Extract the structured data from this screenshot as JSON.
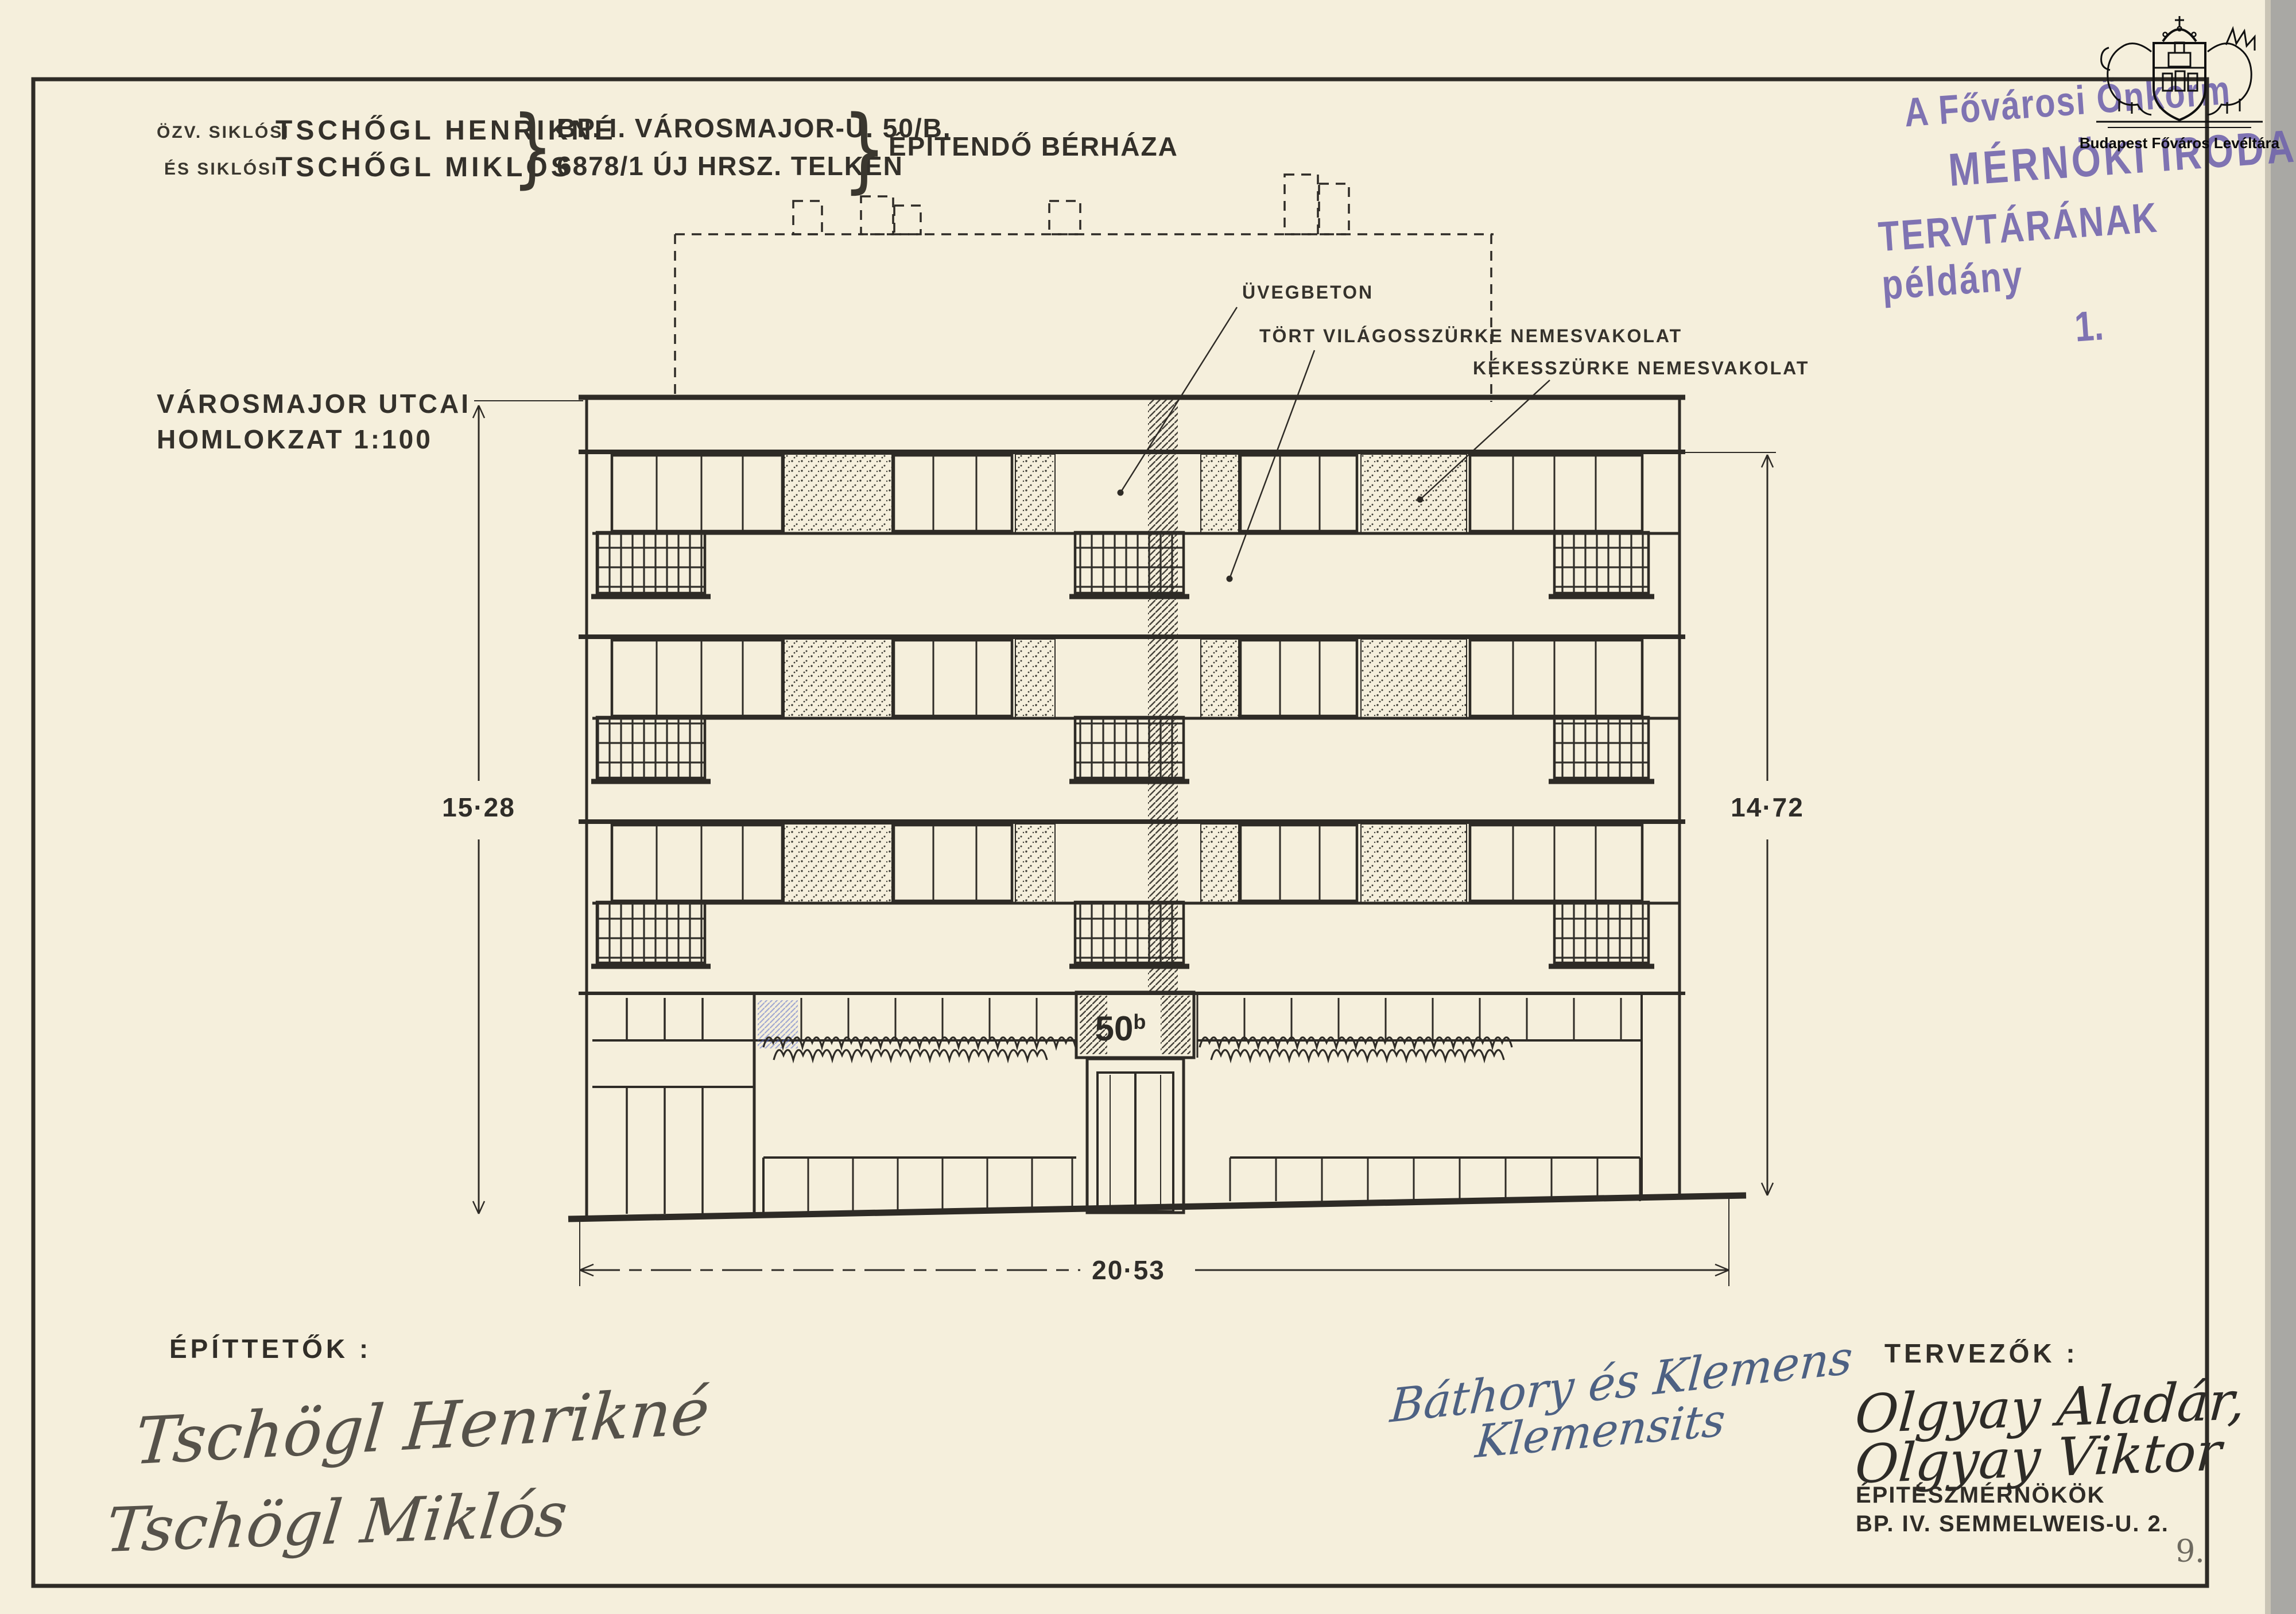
{
  "header": {
    "owner_prefix_1": "ÖZV. SIKLÓSI",
    "owner_name_1": "TSCHŐGL HENRIKNÉ",
    "owner_prefix_2": "ÉS SIKLÓSI",
    "owner_name_2": "TSCHŐGL MIKLÓS",
    "brace": "}",
    "address_line_1": "BP. I. VÁROSMAJOR-U. 50/B.",
    "address_line_2": "6878/1 ÚJ HRSZ. TELKEN",
    "project": "ÉPITENDŐ BÉRHÁZA"
  },
  "stamp": {
    "line1": "A Fővárosi Önkorm",
    "line2": "MÉRNÖKI IRODA",
    "line3": "TERVTÁRÁNAK példány",
    "line4": "1.",
    "ink_color": "#6f63ad"
  },
  "archive_logo": {
    "caption": "Budapest Főváros Levéltára"
  },
  "drawing": {
    "view_title_line1": "VÁROSMAJOR UTCAI",
    "view_title_line2": "HOMLOKZAT 1:100",
    "labels": {
      "glass_block": "ÜVEGBETON",
      "light_grey": "TÖRT VILÁGOSSZÜRKE NEMESVAKOLAT",
      "blue_grey": "KÉKESSZÜRKE NEMESVAKOLAT"
    },
    "house_number": "50",
    "house_number_sup": "b",
    "dimensions": {
      "left": "15·28",
      "right": "14·72",
      "bottom": "20·53"
    }
  },
  "signatures": {
    "clients_heading": "ÉPÍTTETŐK :",
    "client_1": "Tschögl Henrikné",
    "client_2": "Tschögl Miklós",
    "approval_1": "Báthory és Klemens",
    "approval_2": "Klemensits",
    "designers_heading": "TERVEZŐK :",
    "designer_1": "Olgyay Aladár,",
    "designer_2": "Olgyay Viktor",
    "designers_title": "ÉPITÉSZMÉRNÖKÖK",
    "designers_address": "BP. IV. SEMMELWEIS-U. 2."
  },
  "page": {
    "sheet_number": "9."
  }
}
